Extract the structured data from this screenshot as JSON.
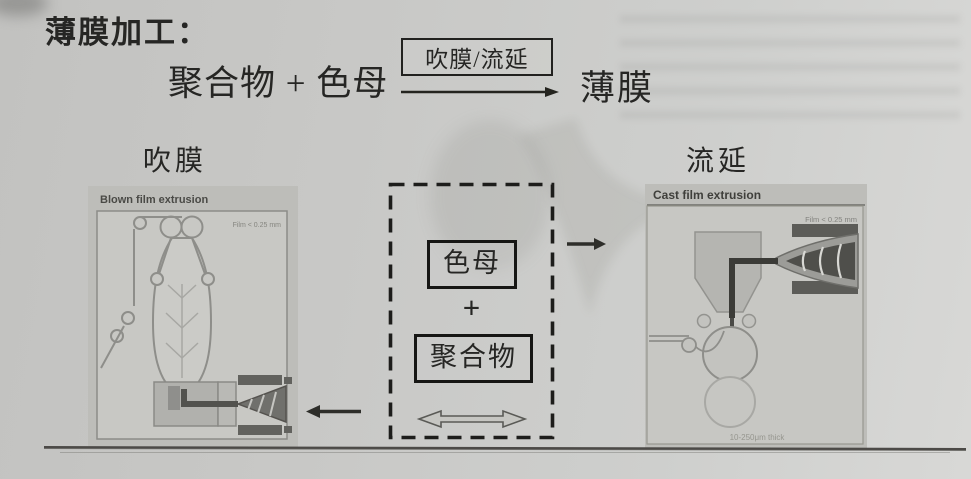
{
  "page": {
    "title": "薄膜加工："
  },
  "equation": {
    "reactants": "聚合物 + 色母",
    "condition": "吹膜/流延",
    "product": "薄膜"
  },
  "labels": {
    "blown": "吹膜",
    "cast": "流延"
  },
  "blown_figure": {
    "caption": "Blown film extrusion",
    "film_note": "Film < 0.25 mm"
  },
  "cast_figure": {
    "caption": "Cast film extrusion",
    "film_note": "Film < 0.25 mm",
    "thickness_note": "10-250μm thick"
  },
  "mix_box": {
    "masterbatch": "色母",
    "plus": "+",
    "polymer": "聚合物"
  },
  "colors": {
    "paper": "#c8c8c6",
    "ink": "#262624",
    "diagram_line": "#8e8e8a",
    "panel": "#bdbdb9",
    "dark_part": "#5c5c58"
  }
}
